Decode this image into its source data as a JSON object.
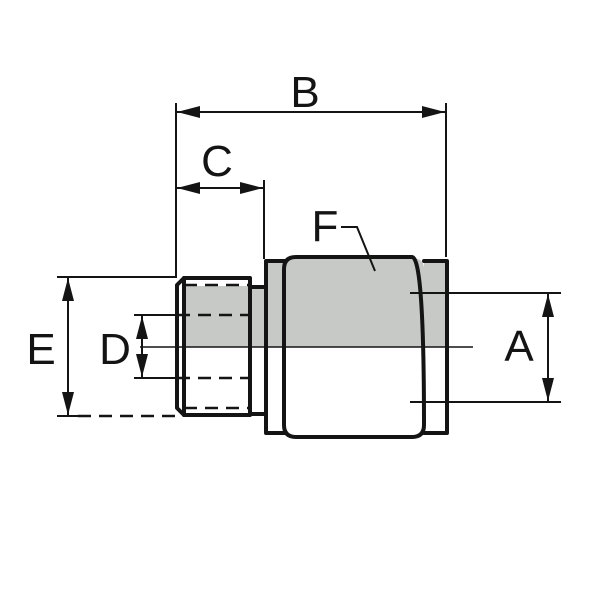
{
  "drawing": {
    "background_color": "#ffffff",
    "line_color": "#141414",
    "section_fill_color": "#c7c9c7",
    "dimension_labels": {
      "a": "A",
      "b": "B",
      "c": "C",
      "d": "D",
      "e": "E",
      "f": "F"
    }
  }
}
